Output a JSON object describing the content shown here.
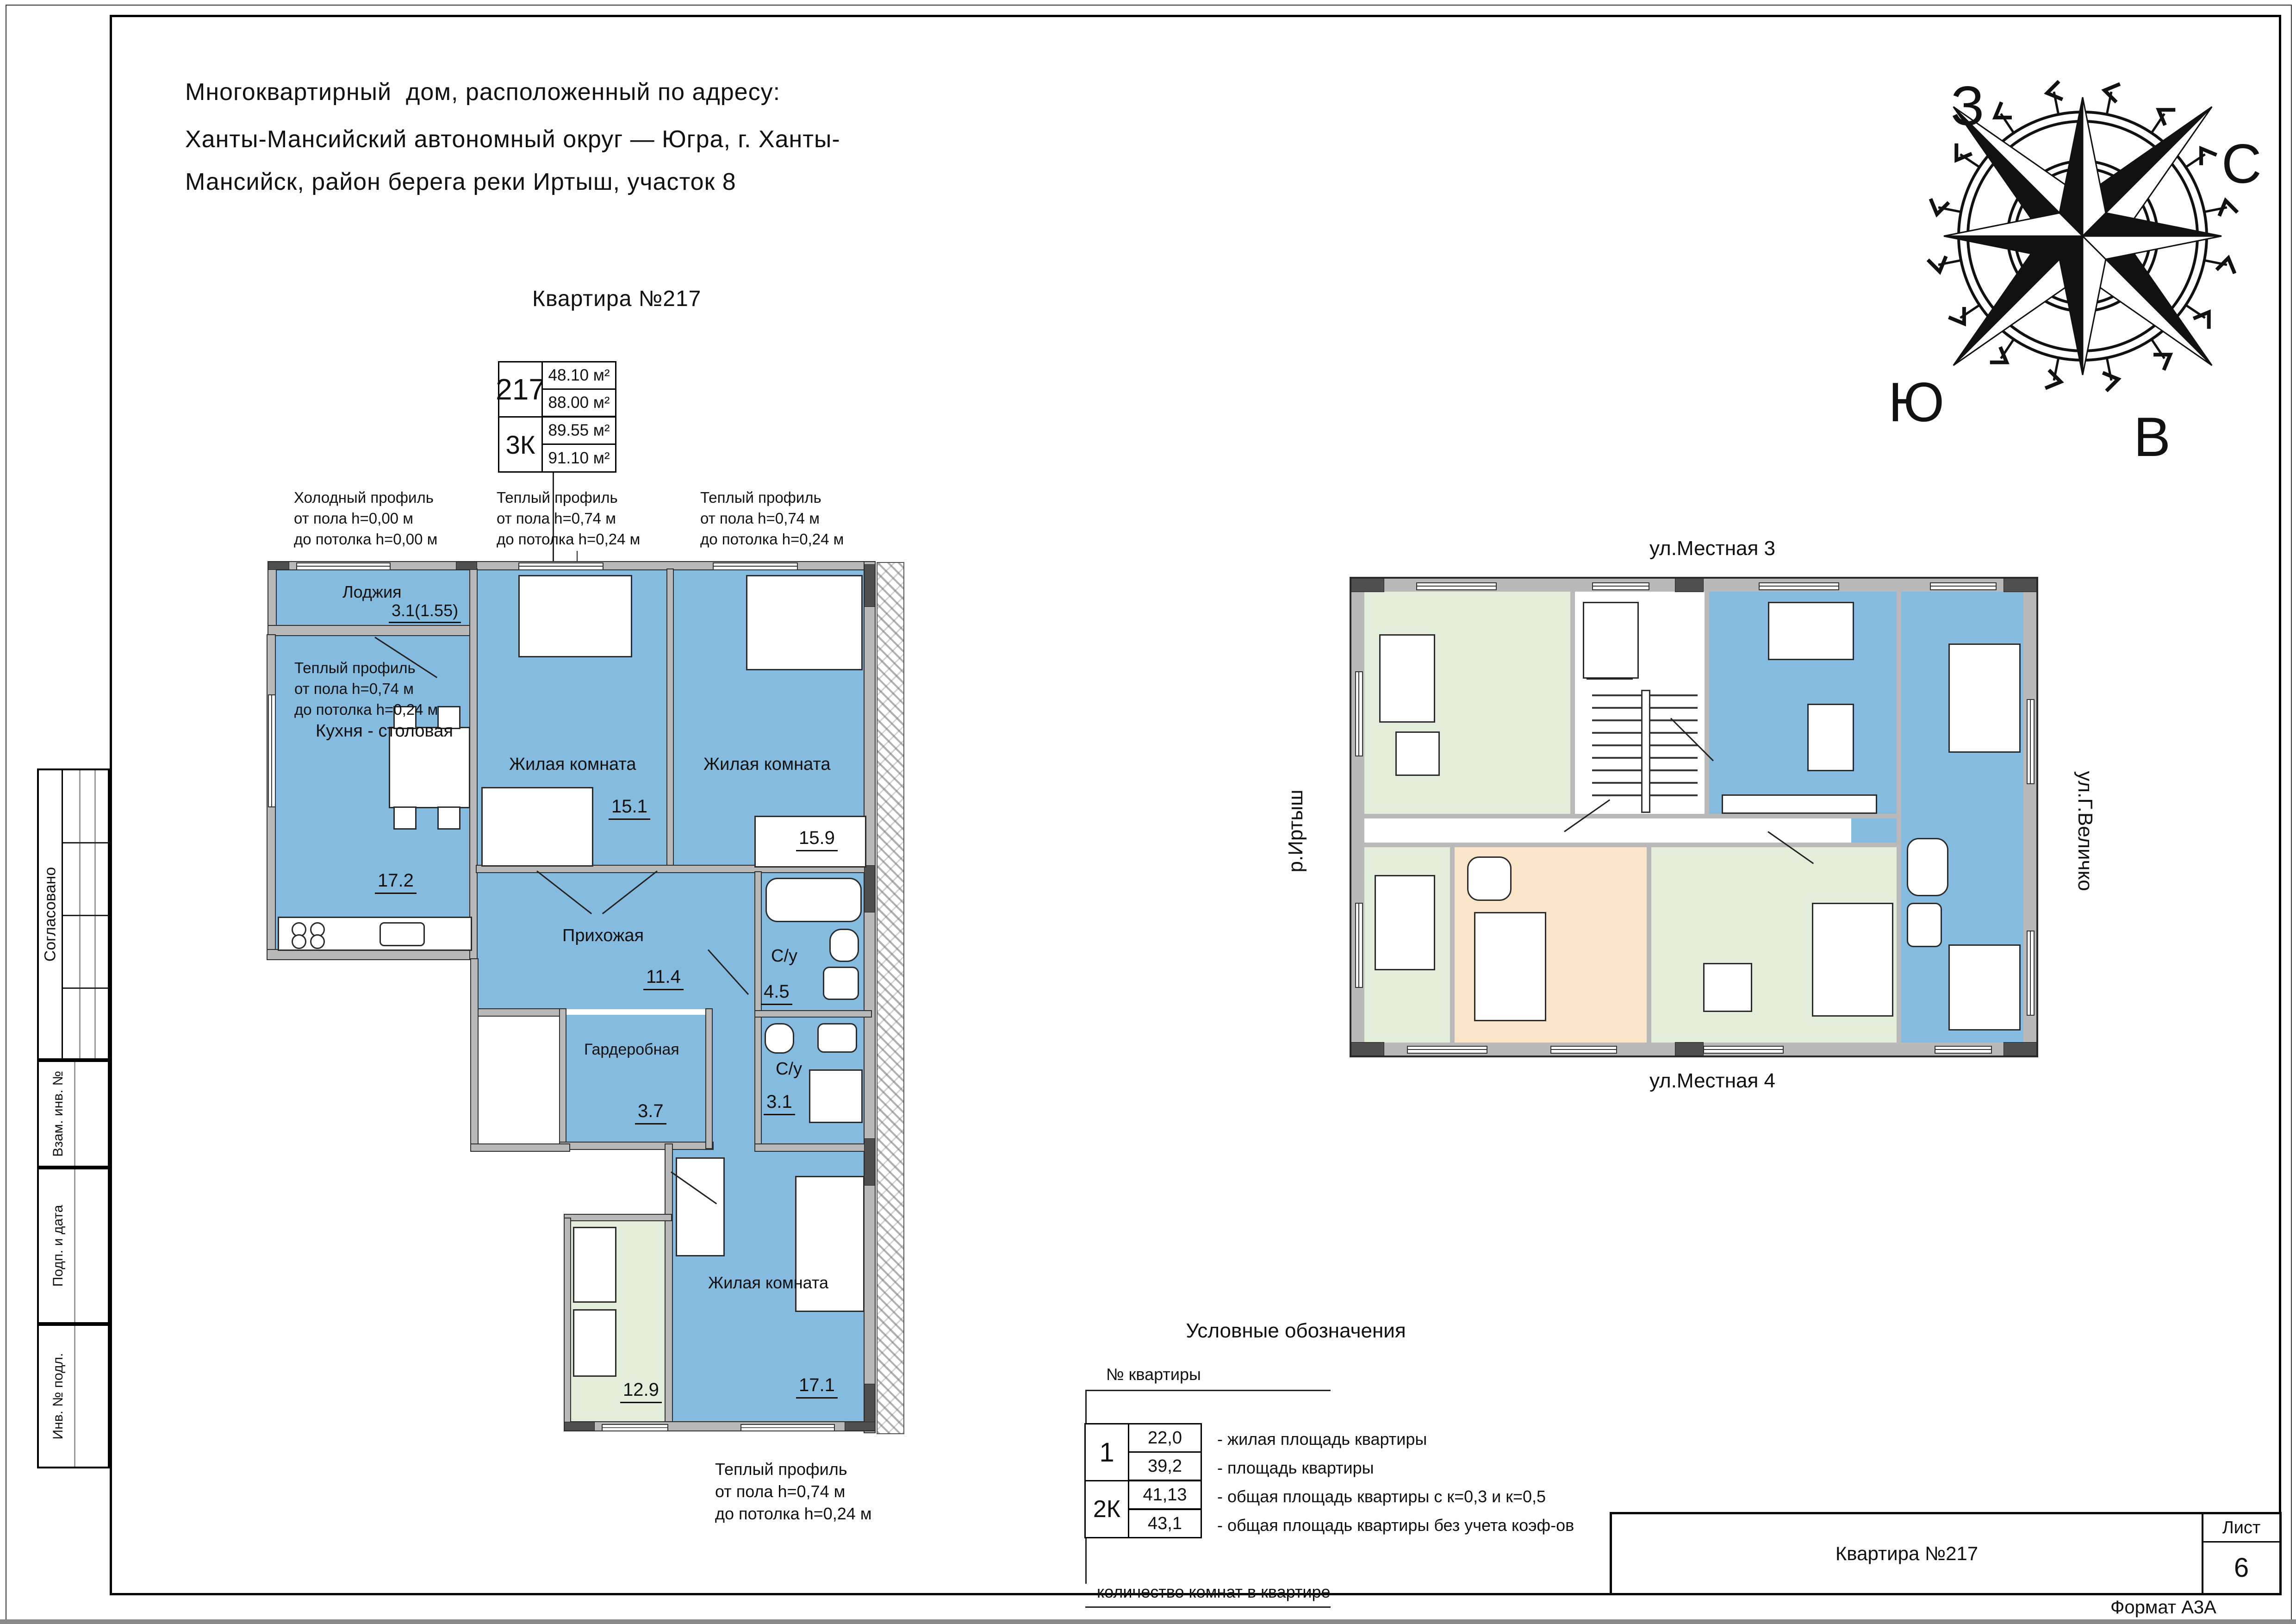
{
  "document": {
    "address_lines": [
      "Многоквартирный  дом, расположенный по адресу:",
      "Ханты-Мансийский автономный округ — Югра, г. Ханты-",
      "Мансийск, район берега реки Иртыш, участок 8"
    ],
    "format_note": "Формат А3А"
  },
  "sidebar": {
    "agreed": "Согласовано",
    "vzam_inv": "Взам. инв. №",
    "podp_data": "Подп. и дата",
    "inv_podl": "Инв. № подл."
  },
  "apartment_card": {
    "heading": "Квартира №217",
    "number": "217",
    "type": "3К",
    "area_living": "48.10 м²",
    "area_flat": "88.00 м²",
    "area_with_coef": "89.55 м²",
    "area_total": "91.10 м²"
  },
  "notes": {
    "cold_profile": {
      "l1": "Холодный профиль",
      "l2": "от пола h=0,00 м",
      "l3": "до потолка h=0,00 м"
    },
    "warm_profile_top1": {
      "l1": "Теплый профиль",
      "l2": "от пола h=0,74 м",
      "l3": "до потолка h=0,24 м"
    },
    "warm_profile_top2": {
      "l1": "Теплый профиль",
      "l2": "от пола h=0,74 м",
      "l3": "до потолка h=0,24 м"
    },
    "warm_profile_kitchen": {
      "l1": "Теплый профиль",
      "l2": "от пола h=0,74 м",
      "l3": "до потолка h=0,24 м"
    },
    "warm_profile_bottom": {
      "l1": "Теплый профиль",
      "l2": "от пола h=0,74 м",
      "l3": "до потолка h=0,24 м"
    }
  },
  "plan": {
    "rooms": {
      "loggia": {
        "name": "Лоджия",
        "area": "3.1(1.55)"
      },
      "kitchen": {
        "name": "Кухня - столовая",
        "area": "17.2"
      },
      "living1": {
        "name": "Жилая комната",
        "area": "15.1"
      },
      "living2": {
        "name": "Жилая комната",
        "area": "15.9"
      },
      "hall": {
        "name": "Прихожая",
        "area": "11.4"
      },
      "wardrobe": {
        "name": "Гардеробная",
        "area": "3.7"
      },
      "bath1": {
        "name": "С/у",
        "area": "4.5"
      },
      "bath2": {
        "name": "С/у",
        "area": "3.1"
      },
      "living3": {
        "name": "Жилая комната",
        "area": "17.1"
      },
      "neighbor": {
        "area": "12.9"
      }
    }
  },
  "site_plan": {
    "street_top": "ул.Местная 3",
    "street_bottom": "ул.Местная 4",
    "river_left": "р.Иртыш",
    "street_right": "ул.Г.Величко"
  },
  "compass": {
    "west": "З",
    "north": "С",
    "south": "Ю",
    "east": "В"
  },
  "legend": {
    "title": "Условные обозначения",
    "apt_number_label": "№ квартиры",
    "sample_number": "1",
    "sample_type": "2К",
    "rows": [
      {
        "value": "22,0",
        "desc": "- жилая площадь квартиры"
      },
      {
        "value": "39,2",
        "desc": "- площадь квартиры"
      },
      {
        "value": "41,13",
        "desc": "- общая площадь квартиры с к=0,3 и к=0,5"
      },
      {
        "value": "43,1",
        "desc": "- общая площадь квартиры без учета коэф-ов"
      }
    ],
    "rooms_count_label": "количество комнат в квартире"
  },
  "title_block": {
    "name": "Квартира №217",
    "sheet_label": "Лист",
    "sheet_number": "6"
  },
  "colors": {
    "flat_blue": "#85bbdf",
    "flat_green": "#e2eed9",
    "flat_orange": "#fbe5c9",
    "wall_gray": "#b9b9b9",
    "wall_dark": "#4f4f4f"
  }
}
